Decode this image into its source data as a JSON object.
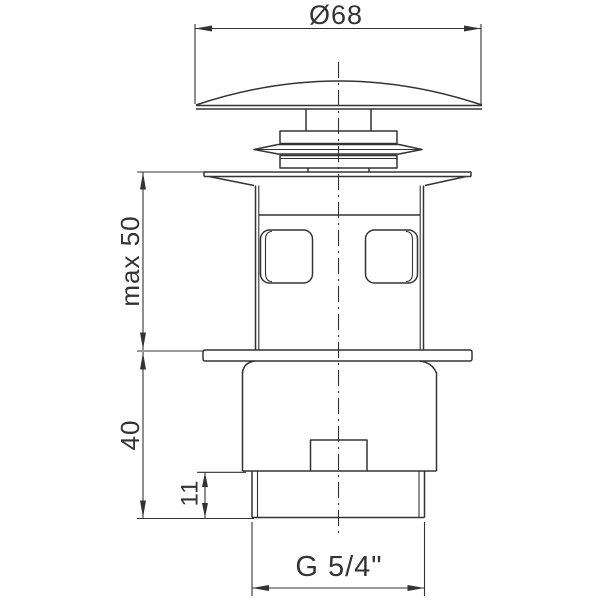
{
  "drawing": {
    "labels": {
      "diameter": "Ø68",
      "max_height": "max 50",
      "body_height": "40",
      "thread_length": "11",
      "thread_size": "G 5/4\""
    },
    "colors": {
      "line": "#333333",
      "background": "#ffffff"
    }
  }
}
